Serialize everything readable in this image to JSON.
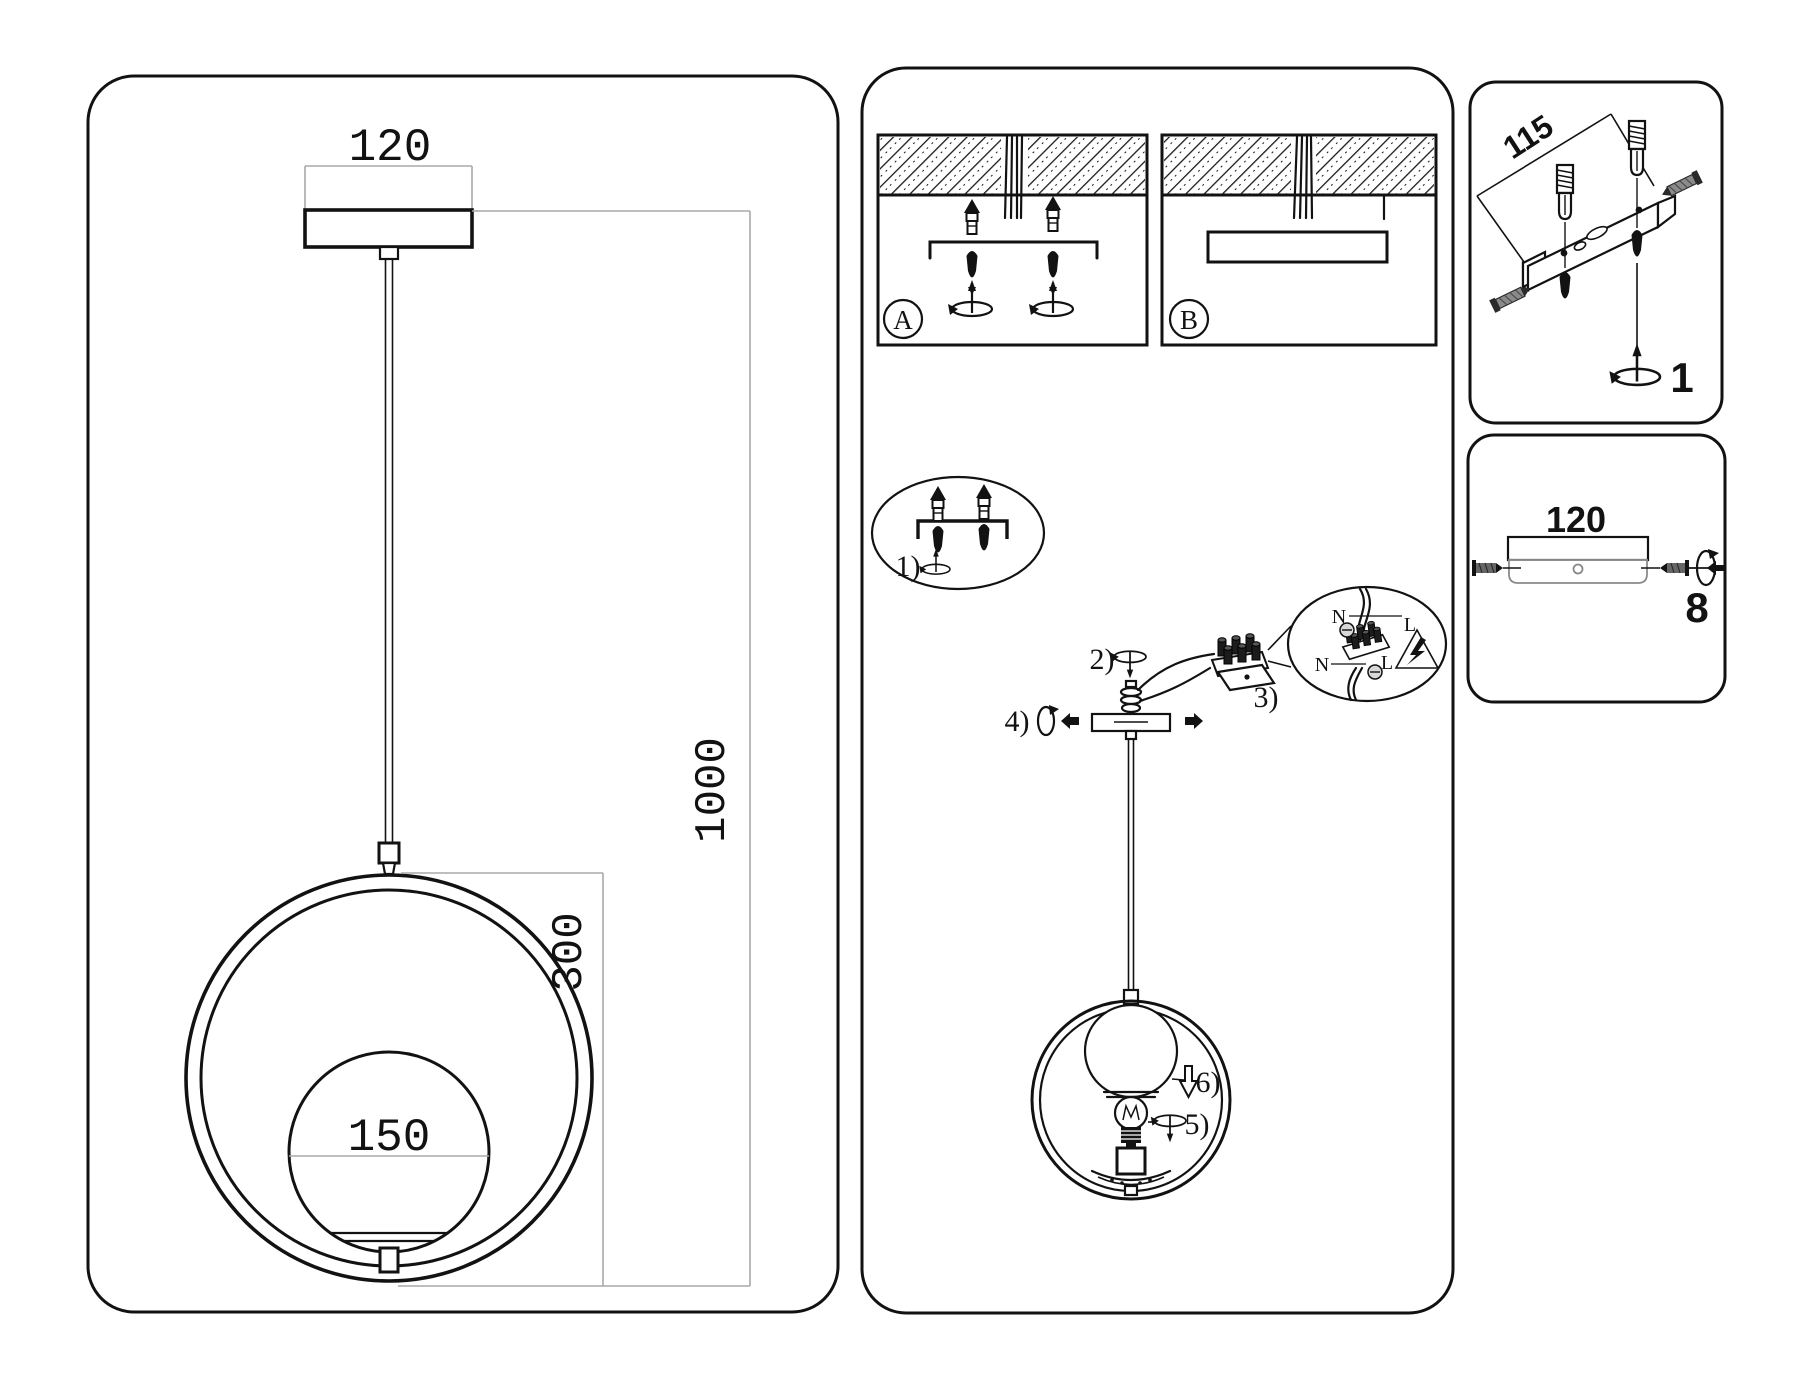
{
  "panels": {
    "drawing": {
      "dim_width": "120",
      "dim_globe": "150",
      "dim_ring": "300",
      "dim_length": "1000"
    },
    "install": {
      "option_a": "A",
      "option_b": "B",
      "step_1": "1)",
      "step_2": "2)",
      "step_3": "3)",
      "step_4": "4)",
      "step_5": "5)",
      "step_6": "6)",
      "terminal": {
        "n_upper": "N",
        "l_upper": "L",
        "n_lower": "N",
        "l_lower": "L"
      }
    },
    "bracket": {
      "dim_length": "115",
      "part_number": "1"
    },
    "canopy": {
      "dim_width": "120",
      "part_number": "8"
    }
  },
  "colors": {
    "ink": "#121212",
    "dimension_line": "#a9a9a9",
    "screw_shade": "#888888",
    "background": "#ffffff"
  }
}
